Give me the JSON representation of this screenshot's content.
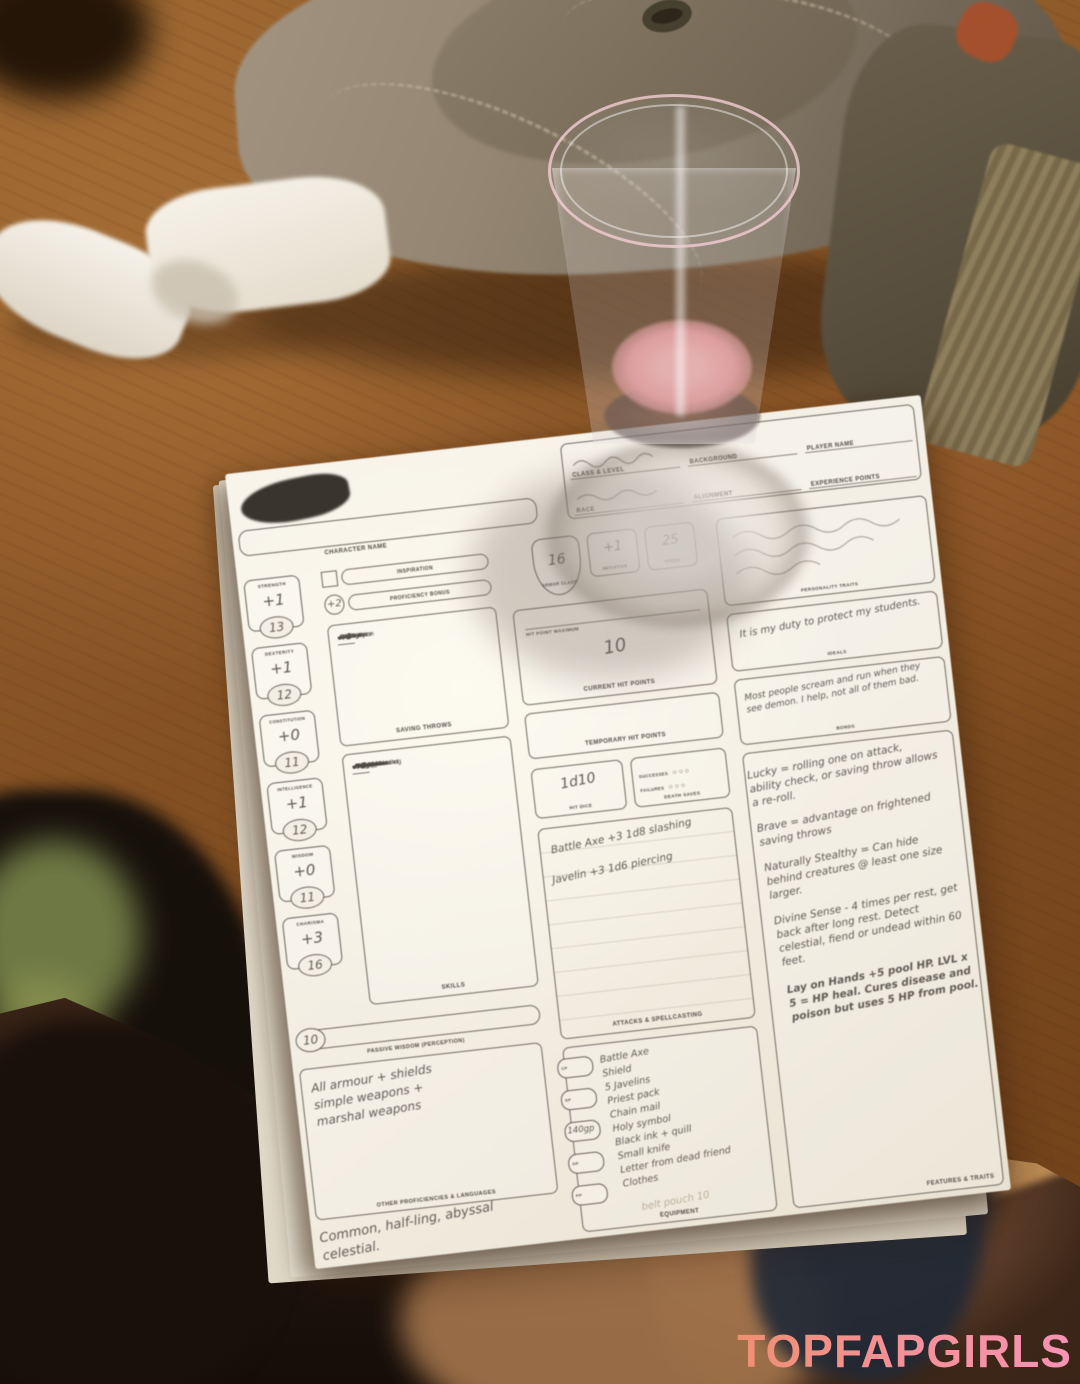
{
  "watermark": {
    "text": "TOPFAPGIRLS",
    "color_left": "#ef8f72",
    "color_right": "#f793b4"
  },
  "sheet": {
    "header": {
      "name_label": "CHARACTER NAME",
      "field_labels": [
        "CLASS & LEVEL",
        "BACKGROUND",
        "PLAYER NAME",
        "RACE",
        "ALIGNMENT",
        "EXPERIENCE POINTS"
      ]
    },
    "inspiration_label": "INSPIRATION",
    "proficiency_bonus": "+2",
    "proficiency_label": "PROFICIENCY BONUS",
    "abilities": [
      {
        "label": "STRENGTH",
        "mod": "+1",
        "score": "13"
      },
      {
        "label": "DEXTERITY",
        "mod": "+1",
        "score": "12"
      },
      {
        "label": "CONSTITUTION",
        "mod": "+0",
        "score": "11"
      },
      {
        "label": "INTELLIGENCE",
        "mod": "+1",
        "score": "12"
      },
      {
        "label": "WISDOM",
        "mod": "+0",
        "score": "11"
      },
      {
        "label": "CHARISMA",
        "mod": "+3",
        "score": "16"
      }
    ],
    "saving_throws": {
      "label": "SAVING THROWS",
      "rows": [
        {
          "dot": "○",
          "value": "+1",
          "name": "Strength"
        },
        {
          "dot": "○",
          "value": "+1",
          "name": "Dexterity"
        },
        {
          "dot": "○",
          "value": "+0",
          "name": "Constitution"
        },
        {
          "dot": "○",
          "value": "+1",
          "name": "Intelligence"
        },
        {
          "dot": "●",
          "value": "+2",
          "name": "Wisdom"
        },
        {
          "dot": "●",
          "value": "+5",
          "name": "Charisma"
        }
      ]
    },
    "skills": {
      "label": "SKILLS",
      "rows": [
        {
          "dot": "○",
          "value": "+1",
          "name": "Acrobatics"
        },
        {
          "dot": "○",
          "value": "+0",
          "name": "Animal Handling"
        },
        {
          "dot": "●",
          "value": "+3",
          "name": "Arcana"
        },
        {
          "dot": "○",
          "value": "+1",
          "name": "Athletics"
        },
        {
          "dot": "○",
          "value": "+3",
          "name": "Deception"
        },
        {
          "dot": "●",
          "value": "+3",
          "name": "History"
        },
        {
          "dot": "○",
          "value": "+0",
          "name": "Insight"
        },
        {
          "dot": "○",
          "value": "+3",
          "name": "Intimidation"
        },
        {
          "dot": "○",
          "value": "+1",
          "name": "Investigation"
        },
        {
          "dot": "●",
          "value": "+2",
          "name": "Medicine"
        },
        {
          "dot": "○",
          "value": "+1",
          "name": "Nature"
        },
        {
          "dot": "○",
          "value": "+0",
          "name": "Perception"
        },
        {
          "dot": "○",
          "value": "+3",
          "name": "Performance"
        },
        {
          "dot": "●",
          "value": "+5",
          "name": "Persuasion"
        },
        {
          "dot": "○",
          "value": "+1",
          "name": "Religion"
        },
        {
          "dot": "○",
          "value": "+1",
          "name": "Sleight of Hand"
        },
        {
          "dot": "○",
          "value": "+1",
          "name": "Stealth"
        },
        {
          "dot": "○",
          "value": "+0",
          "name": "Survival"
        }
      ]
    },
    "passive": {
      "value": "10",
      "label": "PASSIVE WISDOM (PERCEPTION)"
    },
    "proficiencies_box": {
      "text": "All armour + shields\nsimple weapons +\nmarshal weapons",
      "label": "OTHER PROFICIENCIES & LANGUAGES"
    },
    "languages_note": "Common, half-ling, abyssal\ncelestial.",
    "combat": {
      "ac": "16",
      "ac_label": "ARMOR CLASS",
      "initiative": "+1",
      "initiative_label": "INITIATIVE",
      "speed": "25",
      "speed_label": "SPEED",
      "hp_max_label": "HIT POINT MAXIMUM",
      "current_hp": "10",
      "current_hp_label": "CURRENT HIT POINTS",
      "temp_hp_label": "TEMPORARY HIT POINTS",
      "hit_dice": "1d10",
      "hit_dice_label": "HIT DICE",
      "death_saves": {
        "label": "DEATH SAVES",
        "successes_label": "SUCCESSES",
        "failures_label": "FAILURES",
        "pips": "○ ○ ○"
      }
    },
    "attacks": {
      "label": "ATTACKS & SPELLCASTING",
      "rows": [
        "Battle Axe +3 1d8 slashing",
        "Javelin +3 1d6 piercing"
      ]
    },
    "equipment": {
      "label": "EQUIPMENT",
      "coin_labels": [
        "CP",
        "SP",
        "EP",
        "GP",
        "PP"
      ],
      "coin_note": "140gp",
      "items": [
        "Battle Axe",
        "Shield",
        "5 Javelins",
        "Priest pack",
        "Chain mail",
        "Holy symbol",
        "Black ink + quill",
        "Small knife",
        "Letter from dead friend",
        "Clothes"
      ],
      "faint_note": "belt pouch 10"
    },
    "personality": {
      "traits_label": "PERSONALITY TRAITS",
      "ideals": "It is my duty to protect my students.",
      "ideals_label": "IDEALS",
      "bonds": "Most people scream and run when they see demon. I help, not all of them bad.",
      "bonds_label": "BONDS"
    },
    "features": {
      "label": "FEATURES & TRAITS",
      "notes": [
        "Lucky = rolling one on attack, ability check, or saving throw allows a re-roll.",
        "Brave = advantage on frightened saving throws",
        "Naturally Stealthy = Can hide behind creatures @ least one size larger.",
        "Divine Sense - 4 times per rest, get back after long rest. Detect celestial, fiend or undead within 60 feet.",
        "Lay on Hands +5 pool HP.  LVL x 5 = HP heal. Cures disease and poison but uses 5 HP from pool."
      ]
    }
  }
}
